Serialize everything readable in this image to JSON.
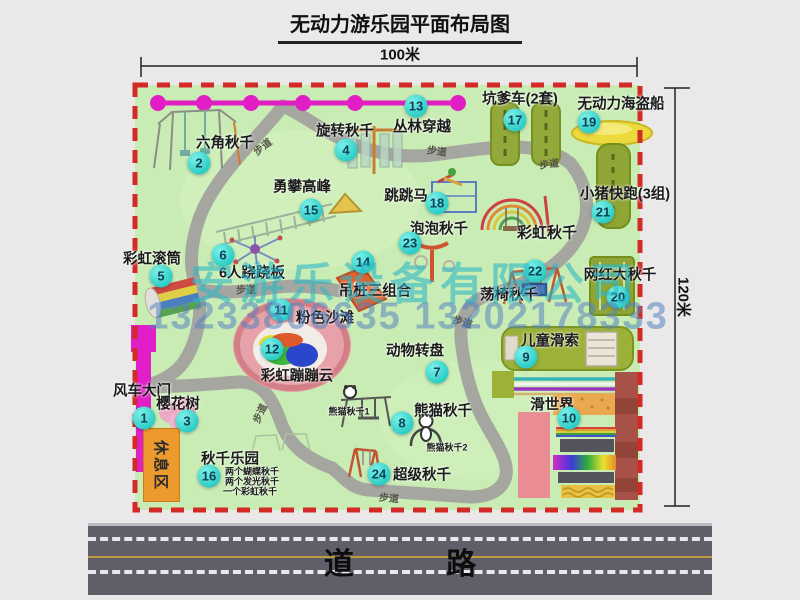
{
  "title": "无动力游乐园平面布局图",
  "dimensions": {
    "width_label": "100米",
    "height_label": "120米"
  },
  "road": {
    "label": "道 路"
  },
  "watermark": {
    "company": "安游乐设备有限公司",
    "phones": "13233806635 13202178333"
  },
  "rest_area_label": "休息区",
  "walkway_label": "步道",
  "park": {
    "items": [
      {
        "num": "1",
        "label": "风车大门",
        "lx": 142,
        "ly": 390,
        "bx": 144,
        "by": 418
      },
      {
        "num": "2",
        "label": "六角秋千",
        "lx": 225,
        "ly": 142,
        "bx": 199,
        "by": 163
      },
      {
        "num": "3",
        "label": "樱花树",
        "lx": 178,
        "ly": 403,
        "bx": 187,
        "by": 421
      },
      {
        "num": "4",
        "label": "旋转秋千",
        "lx": 345,
        "ly": 130,
        "bx": 346,
        "by": 150
      },
      {
        "num": "5",
        "label": "彩虹滚筒",
        "lx": 152,
        "ly": 258,
        "bx": 161,
        "by": 276
      },
      {
        "num": "6",
        "label": "6人跷跷板",
        "lx": 252,
        "ly": 272,
        "bx": 223,
        "by": 255
      },
      {
        "num": "7",
        "label": "动物转盘",
        "lx": 415,
        "ly": 350,
        "bx": 437,
        "by": 372
      },
      {
        "num": "8",
        "label": "熊猫秋千",
        "lx": 443,
        "ly": 410,
        "bx": 402,
        "by": 423
      },
      {
        "num": "9",
        "label": "儿童滑索",
        "lx": 550,
        "ly": 340,
        "bx": 526,
        "by": 357
      },
      {
        "num": "10",
        "label": "滑世界",
        "lx": 552,
        "ly": 404,
        "bx": 569,
        "by": 418
      },
      {
        "num": "11",
        "label": "粉色沙滩",
        "lx": 325,
        "ly": 317,
        "bx": 281,
        "by": 310
      },
      {
        "num": "12",
        "label": "彩虹蹦蹦云",
        "lx": 297,
        "ly": 375,
        "bx": 272,
        "by": 349
      },
      {
        "num": "13",
        "label": "丛林穿越",
        "lx": 422,
        "ly": 126,
        "bx": 416,
        "by": 106
      },
      {
        "num": "14",
        "label": "吊桩三组合",
        "lx": 375,
        "ly": 290,
        "bx": 363,
        "by": 262
      },
      {
        "num": "15",
        "label": "勇攀高峰",
        "lx": 302,
        "ly": 186,
        "bx": 311,
        "by": 210
      },
      {
        "num": "16",
        "label": "秋千乐园",
        "lx": 230,
        "ly": 458,
        "bx": 209,
        "by": 476
      },
      {
        "num": "17",
        "label": "坑爹车(2套)",
        "lx": 520,
        "ly": 98,
        "bx": 515,
        "by": 120
      },
      {
        "num": "18",
        "label": "跳跳马",
        "lx": 406,
        "ly": 195,
        "bx": 437,
        "by": 203
      },
      {
        "num": "19",
        "label": "无动力海盗船",
        "lx": 621,
        "ly": 103,
        "bx": 589,
        "by": 122
      },
      {
        "num": "20",
        "label": "网红大秋千",
        "lx": 620,
        "ly": 274,
        "bx": 618,
        "by": 297
      },
      {
        "num": "21",
        "label": "小猪快跑(3组)",
        "lx": 625,
        "ly": 193,
        "bx": 603,
        "by": 212
      },
      {
        "num": "22",
        "label": "荡椅秋千",
        "lx": 509,
        "ly": 294,
        "bx": 535,
        "by": 271
      },
      {
        "num": "23",
        "label": "泡泡秋千",
        "lx": 439,
        "ly": 228,
        "bx": 410,
        "by": 243
      },
      {
        "num": "24",
        "label": "超级秋千",
        "lx": 422,
        "ly": 474,
        "bx": 379,
        "by": 474
      }
    ],
    "extra_labels": [
      {
        "text": "彩虹秋千",
        "x": 547,
        "y": 232,
        "size": 15,
        "bold": true
      },
      {
        "text": "熊猫秋千1",
        "x": 349,
        "y": 411,
        "size": 9,
        "bold": true
      },
      {
        "text": "熊猫秋千2",
        "x": 447,
        "y": 447,
        "size": 9,
        "bold": true
      },
      {
        "text": "两个蝴蝶秋千",
        "x": 252,
        "y": 471,
        "size": 9,
        "bold": true
      },
      {
        "text": "两个发光秋千",
        "x": 252,
        "y": 481,
        "size": 9,
        "bold": true
      },
      {
        "text": "一个彩虹秋千",
        "x": 250,
        "y": 491,
        "size": 9,
        "bold": true
      }
    ],
    "walkway_label_positions": [
      {
        "x": 262,
        "y": 146,
        "rot": -38
      },
      {
        "x": 437,
        "y": 150,
        "rot": 8
      },
      {
        "x": 549,
        "y": 163,
        "rot": -8
      },
      {
        "x": 246,
        "y": 289,
        "rot": 0
      },
      {
        "x": 463,
        "y": 321,
        "rot": 18
      },
      {
        "x": 259,
        "y": 413,
        "rot": -65
      },
      {
        "x": 389,
        "y": 497,
        "rot": 5
      }
    ]
  }
}
